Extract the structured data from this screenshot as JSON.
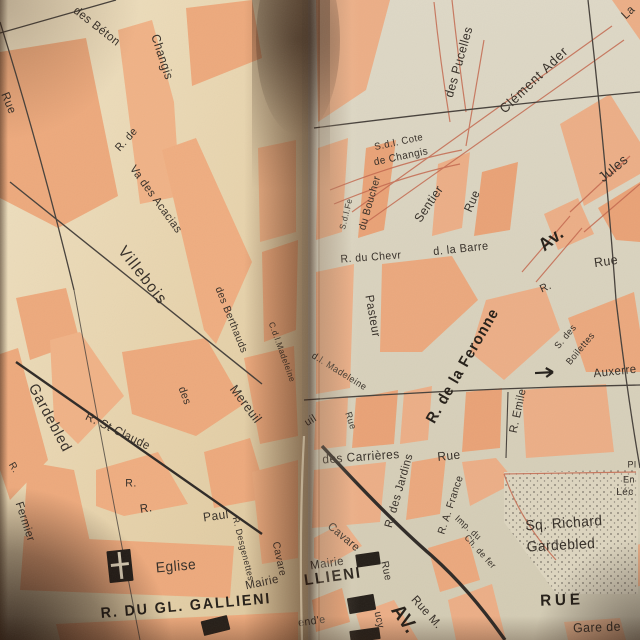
{
  "map": {
    "colors": {
      "paper_left": "#e8d6b2",
      "paper_right": "#d9d2bd",
      "block_salmon": "#eda97c",
      "ink": "#342d26",
      "red_line": "#c4684e",
      "square_fill": "#ddd5bf"
    },
    "labels": [
      {
        "text": "des Béton",
        "x": 97,
        "y": 26,
        "rot": 38,
        "size": 12
      },
      {
        "text": "Changis",
        "x": 162,
        "y": 57,
        "rot": 72,
        "size": 12.5
      },
      {
        "text": "Rue",
        "x": 9,
        "y": 103,
        "rot": 68,
        "size": 12
      },
      {
        "text": "R. de",
        "x": 127,
        "y": 140,
        "rot": -48,
        "size": 11
      },
      {
        "text": "Va des Acacias",
        "x": 155,
        "y": 200,
        "rot": 54,
        "size": 11.5
      },
      {
        "text": "Villebois",
        "x": 142,
        "y": 276,
        "rot": 52,
        "size": 16,
        "ls": 1.5
      },
      {
        "text": "des Berthauds",
        "x": 231,
        "y": 320,
        "rot": 68,
        "size": 10.5
      },
      {
        "text": "C.d.l.Madeleine",
        "x": 282,
        "y": 352,
        "rot": 70,
        "size": 8.5
      },
      {
        "text": "Mereuil",
        "x": 246,
        "y": 404,
        "rot": 53,
        "size": 13
      },
      {
        "text": "des",
        "x": 184,
        "y": 396,
        "rot": 70,
        "size": 11
      },
      {
        "text": "Gardebled",
        "x": 50,
        "y": 418,
        "rot": 62,
        "size": 15,
        "ls": 1
      },
      {
        "text": "R. St Claude",
        "x": 118,
        "y": 431,
        "rot": 26,
        "size": 12
      },
      {
        "text": "R.",
        "x": 131,
        "y": 484,
        "rot": 0,
        "size": 11
      },
      {
        "text": "R.",
        "x": 146,
        "y": 508,
        "rot": -8,
        "size": 12
      },
      {
        "text": "Paul",
        "x": 216,
        "y": 516,
        "rot": -8,
        "size": 12.5
      },
      {
        "text": "R.",
        "x": 13,
        "y": 468,
        "rot": 60,
        "size": 10
      },
      {
        "text": "Fermier",
        "x": 24,
        "y": 522,
        "rot": 72,
        "size": 11.5
      },
      {
        "text": "Eglise",
        "x": 176,
        "y": 567,
        "rot": -5,
        "size": 14.5
      },
      {
        "text": "Mairie",
        "x": 262,
        "y": 582,
        "rot": -12,
        "size": 12
      },
      {
        "text": "R. Desgenettes",
        "x": 243,
        "y": 549,
        "rot": 76,
        "size": 9
      },
      {
        "text": "Cavare",
        "x": 279,
        "y": 559,
        "rot": 78,
        "size": 10.5
      },
      {
        "text": "R. DU GL. GALLIENI",
        "x": 186,
        "y": 606,
        "rot": -5,
        "size": 15,
        "bold": true,
        "ls": 2
      },
      {
        "text": "S.d.l. Cote",
        "x": 399,
        "y": 143,
        "rot": -12,
        "size": 10
      },
      {
        "text": "de Changis",
        "x": 401,
        "y": 157,
        "rot": -12,
        "size": 10.5
      },
      {
        "text": "des Pucelles",
        "x": 459,
        "y": 62,
        "rot": -74,
        "size": 12.5
      },
      {
        "text": "Clément Ader",
        "x": 534,
        "y": 80,
        "rot": -44,
        "size": 13.5,
        "ls": 1
      },
      {
        "text": "La",
        "x": 628,
        "y": 12,
        "rot": -44,
        "size": 12
      },
      {
        "text": "Jules",
        "x": 613,
        "y": 168,
        "rot": -40,
        "size": 14
      },
      {
        "text": "S.d.l.Fe",
        "x": 346,
        "y": 214,
        "rot": -76,
        "size": 8.5
      },
      {
        "text": "du Boucher",
        "x": 370,
        "y": 203,
        "rot": -74,
        "size": 10.5
      },
      {
        "text": "Sentier",
        "x": 429,
        "y": 204,
        "rot": -56,
        "size": 12.5
      },
      {
        "text": "Rue",
        "x": 472,
        "y": 201,
        "rot": -66,
        "size": 12
      },
      {
        "text": "R. du Chevr",
        "x": 371,
        "y": 258,
        "rot": -4,
        "size": 11
      },
      {
        "text": "d. la Barre",
        "x": 461,
        "y": 250,
        "rot": -6,
        "size": 11.5
      },
      {
        "text": "Av.",
        "x": 551,
        "y": 239,
        "rot": -38,
        "size": 18,
        "bold": true
      },
      {
        "text": "Rue",
        "x": 606,
        "y": 261,
        "rot": -8,
        "size": 13
      },
      {
        "text": "R.",
        "x": 546,
        "y": 288,
        "rot": -24,
        "size": 11
      },
      {
        "text": "Pasteur",
        "x": 373,
        "y": 316,
        "rot": 80,
        "size": 12
      },
      {
        "text": "d.l. Madeleine",
        "x": 339,
        "y": 372,
        "rot": 32,
        "size": 9.5
      },
      {
        "text": "Rue",
        "x": 350,
        "y": 421,
        "rot": 72,
        "size": 9.5
      },
      {
        "text": "R. de la Feronne",
        "x": 463,
        "y": 366,
        "rot": -60,
        "size": 15.5,
        "bold": true,
        "ls": 1
      },
      {
        "text": "uil",
        "x": 311,
        "y": 421,
        "rot": -32,
        "size": 11
      },
      {
        "text": "des Carrières",
        "x": 361,
        "y": 457,
        "rot": -4,
        "size": 12.5
      },
      {
        "text": "Rue",
        "x": 449,
        "y": 456,
        "rot": -6,
        "size": 12.5
      },
      {
        "text": "R. des Jardins",
        "x": 400,
        "y": 491,
        "rot": -74,
        "size": 11.5
      },
      {
        "text": "R. A. France",
        "x": 451,
        "y": 505,
        "rot": -72,
        "size": 10.5
      },
      {
        "text": "Imp. du",
        "x": 468,
        "y": 528,
        "rot": 42,
        "size": 9
      },
      {
        "text": "Ch. de fer",
        "x": 480,
        "y": 552,
        "rot": 48,
        "size": 9
      },
      {
        "text": "Sq.  Richard",
        "x": 564,
        "y": 524,
        "rot": -4,
        "size": 14.5
      },
      {
        "text": "Gardebled",
        "x": 561,
        "y": 546,
        "rot": -3,
        "size": 14.5
      },
      {
        "text": "R. Emile",
        "x": 519,
        "y": 411,
        "rot": -78,
        "size": 11.5
      },
      {
        "text": "S. des",
        "x": 566,
        "y": 337,
        "rot": -50,
        "size": 9.5
      },
      {
        "text": "Boilettes",
        "x": 581,
        "y": 349,
        "rot": -50,
        "size": 9.5
      },
      {
        "text": "Auxerre",
        "x": 615,
        "y": 371,
        "rot": -6,
        "size": 12
      },
      {
        "text": "Pl",
        "x": 632,
        "y": 465,
        "rot": 0,
        "size": 9.5
      },
      {
        "text": "En",
        "x": 629,
        "y": 480,
        "rot": 0,
        "size": 9.5
      },
      {
        "text": "Léc",
        "x": 625,
        "y": 492,
        "rot": 0,
        "size": 10.5
      },
      {
        "text": "RUE",
        "x": 562,
        "y": 601,
        "rot": -2,
        "size": 16,
        "bold": true,
        "ls": 4
      },
      {
        "text": "Gare de",
        "x": 597,
        "y": 627,
        "rot": -2,
        "size": 13
      },
      {
        "text": "Mairie",
        "x": 327,
        "y": 563,
        "rot": -8,
        "size": 12
      },
      {
        "text": "LLIENI",
        "x": 333,
        "y": 577,
        "rot": -8,
        "size": 15.5,
        "bold": true,
        "ls": 2
      },
      {
        "text": "Cavare",
        "x": 343,
        "y": 538,
        "rot": 40,
        "size": 11.5
      },
      {
        "text": "Rue",
        "x": 386,
        "y": 571,
        "rot": 78,
        "size": 10.5
      },
      {
        "text": "ucy",
        "x": 379,
        "y": 620,
        "rot": 78,
        "size": 10.5
      },
      {
        "text": "Rue M.",
        "x": 427,
        "y": 612,
        "rot": 48,
        "size": 12
      },
      {
        "text": "AV.",
        "x": 404,
        "y": 619,
        "rot": 55,
        "size": 20,
        "bold": true
      },
      {
        "text": "end'e",
        "x": 312,
        "y": 622,
        "rot": -8,
        "size": 11
      }
    ],
    "symbols": [
      {
        "name": "church-icon",
        "x": 108,
        "y": 550,
        "w": 24,
        "h": 32,
        "rot": -6
      },
      {
        "name": "town-hall-icon",
        "x": 356,
        "y": 553,
        "w": 24,
        "h": 13,
        "rot": -8
      },
      {
        "name": "building-icon",
        "x": 348,
        "y": 596,
        "w": 27,
        "h": 16,
        "rot": -10
      },
      {
        "name": "building-icon",
        "x": 202,
        "y": 618,
        "w": 27,
        "h": 15,
        "rot": -14
      },
      {
        "name": "building-icon",
        "x": 350,
        "y": 629,
        "w": 30,
        "h": 12,
        "rot": -8
      },
      {
        "name": "direction-arrow-icon",
        "x": 534,
        "y": 366,
        "w": 24,
        "h": 13,
        "rot": -3
      }
    ]
  }
}
